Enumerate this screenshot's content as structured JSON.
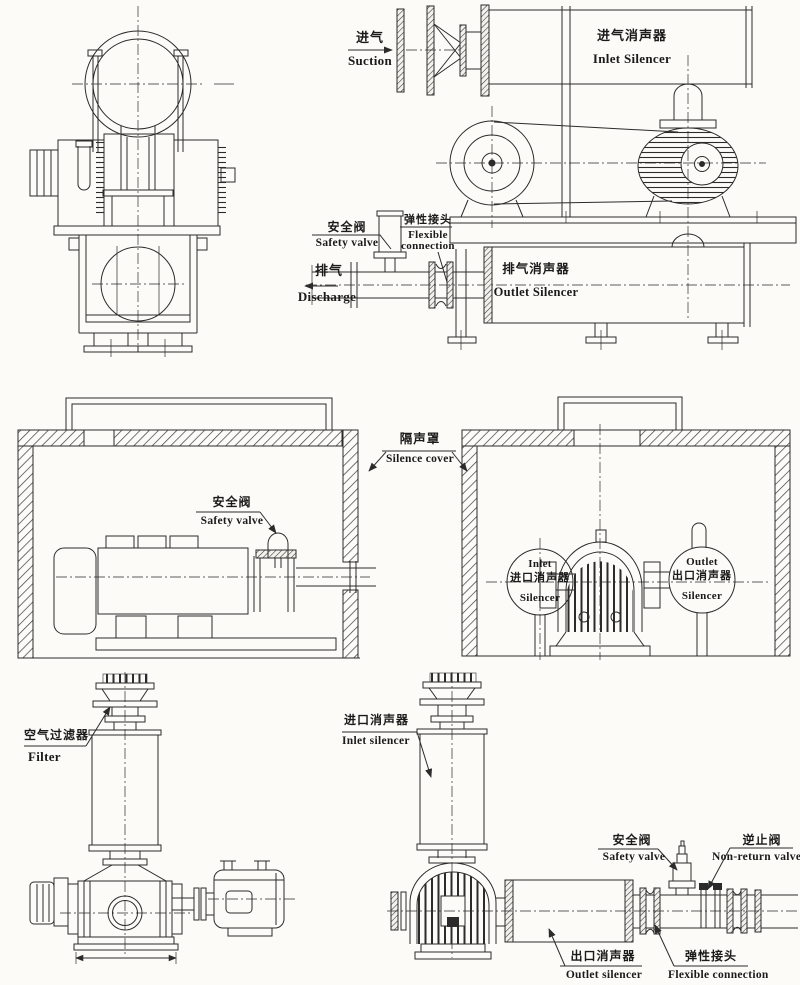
{
  "page": {
    "background_color": "#fcfbf8",
    "ink_color": "#2b2b2b"
  },
  "panels": {
    "top_right": {
      "suction": {
        "zh": "进气",
        "en": "Suction"
      },
      "inlet_silencer": {
        "zh": "进气消声器",
        "en": "Inlet Silencer"
      },
      "safety_valve": {
        "zh": "安全阀",
        "en": "Safety valve"
      },
      "flexible_connection": {
        "zh": "弹性接头",
        "en_line1": "Flexible",
        "en_line2": "connection"
      },
      "discharge": {
        "zh": "排气",
        "en": "Discharge"
      },
      "outlet_silencer": {
        "zh": "排气消声器",
        "en": "Outlet Silencer"
      }
    },
    "middle": {
      "silence_cover": {
        "zh": "隔声罩",
        "en": "Silence cover"
      },
      "safety_valve": {
        "zh": "安全阀",
        "en": "Safety valve"
      },
      "inlet_circle": {
        "en_line1": "Inlet",
        "zh": "进口消声器",
        "en_line2": "Silencer"
      },
      "outlet_circle": {
        "en_line1": "Outlet",
        "zh": "出口消声器",
        "en_line2": "Silencer"
      }
    },
    "bottom_left": {
      "filter": {
        "zh": "空气过滤器",
        "en": "Filter"
      }
    },
    "bottom_right": {
      "inlet_silencer": {
        "zh": "进口消声器",
        "en": "Inlet silencer"
      },
      "safety_valve": {
        "zh": "安全阀",
        "en": "Safety valve"
      },
      "non_return_valve": {
        "zh": "逆止阀",
        "en": "Non-return valve"
      },
      "outlet_silencer": {
        "zh": "出口消声器",
        "en": "Outlet silencer"
      },
      "flexible_connection": {
        "zh": "弹性接头",
        "en": "Flexible connection"
      }
    }
  }
}
